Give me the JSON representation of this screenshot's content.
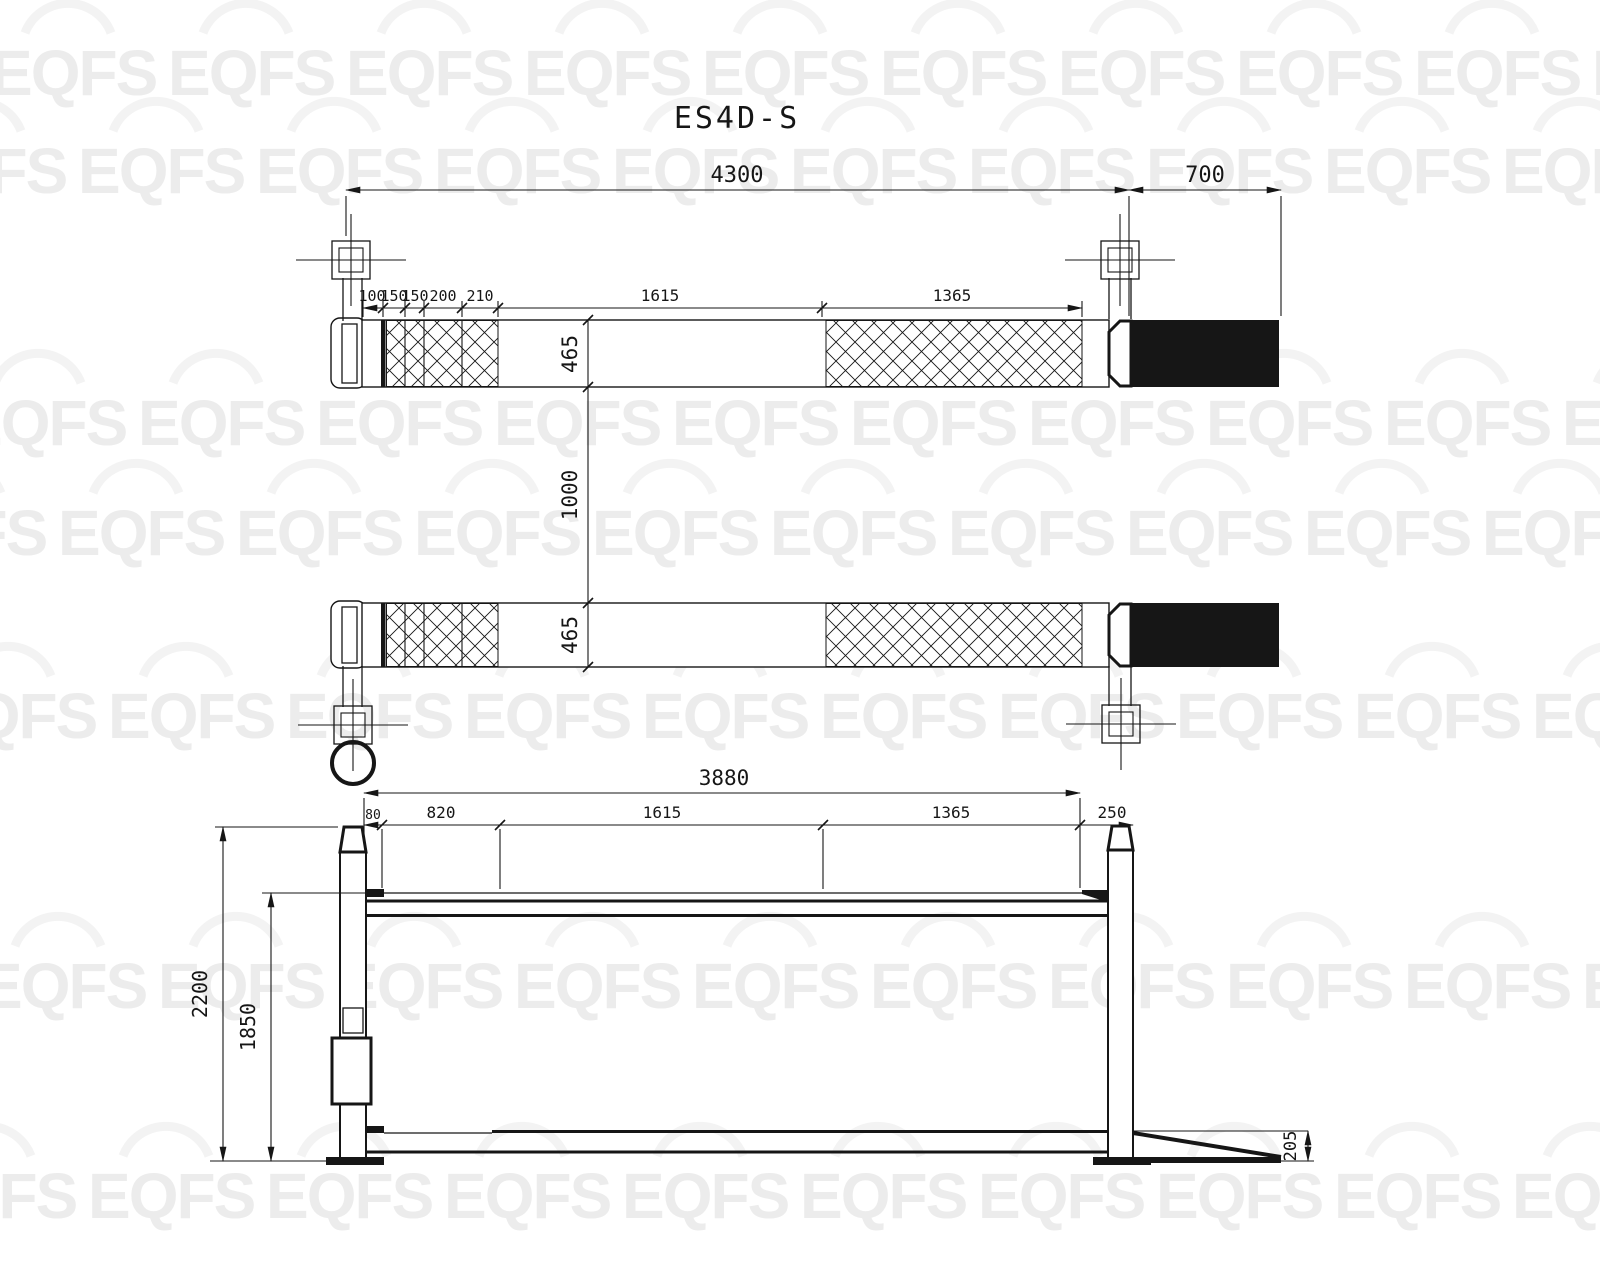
{
  "title": "ES4D-S",
  "watermark": {
    "text": "EQFS",
    "color": "#ececec",
    "arc_color": "#f3f3f3"
  },
  "colors": {
    "background": "#ffffff",
    "line": "#161616",
    "ramp_fill": "#111111"
  },
  "plan_view": {
    "dim_overall_length": "4300",
    "dim_ramp_length": "700",
    "segments": [
      "100",
      "150",
      "150",
      "200",
      "210",
      "1615",
      "1365"
    ],
    "dim_runway_width_front": "465",
    "dim_track_gap": "1000",
    "dim_runway_width_rear": "465"
  },
  "side_view": {
    "dim_runway_length": "3880",
    "segments": [
      "80",
      "820",
      "1615",
      "1365",
      "250"
    ],
    "dim_overall_height": "2200",
    "dim_raised_height": "1850",
    "dim_ramp_height": "205"
  }
}
